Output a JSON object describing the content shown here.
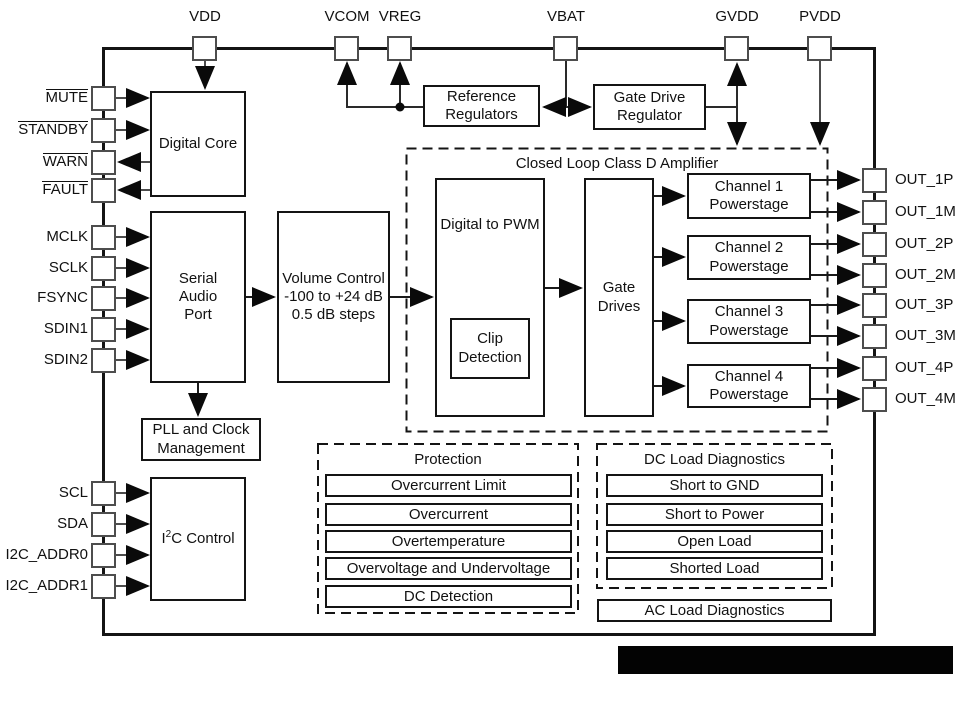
{
  "pins": {
    "top": [
      "VDD",
      "VCOM",
      "VREG",
      "VBAT",
      "GVDD",
      "PVDD"
    ],
    "left": [
      "MUTE",
      "STANDBY",
      "WARN",
      "FAULT",
      "MCLK",
      "SCLK",
      "FSYNC",
      "SDIN1",
      "SDIN2",
      "SCL",
      "SDA",
      "I2C_ADDR0",
      "I2C_ADDR1"
    ],
    "right": [
      "OUT_1P",
      "OUT_1M",
      "OUT_2P",
      "OUT_2M",
      "OUT_3P",
      "OUT_3M",
      "OUT_4P",
      "OUT_4M"
    ]
  },
  "blocks": {
    "digital_core": "Digital Core",
    "serial_audio_port": "Serial\nAudio\nPort",
    "volume_control": "Volume Control\n-100 to +24 dB\n0.5 dB steps",
    "pll": "PLL and Clock\nManagement",
    "i2c_control": {
      "pre": "I",
      "sup": "2",
      "post": "C Control"
    },
    "reference_regulators": "Reference\nRegulators",
    "gate_drive_regulator": "Gate Drive\nRegulator",
    "amp_title": "Closed Loop Class D Amplifier",
    "digital_to_pwm": "Digital to PWM",
    "clip_detection": "Clip\nDetection",
    "gate_drives": "Gate\nDrives",
    "channel1": "Channel 1\nPowerstage",
    "channel2": "Channel 2\nPowerstage",
    "channel3": "Channel 3\nPowerstage",
    "channel4": "Channel 4\nPowerstage"
  },
  "protection": {
    "title": "Protection",
    "rows": [
      "Overcurrent Limit",
      "Overcurrent",
      "Overtemperature",
      "Overvoltage and Undervoltage",
      "DC Detection"
    ]
  },
  "dc_load": {
    "title": "DC Load Diagnostics",
    "rows": [
      "Short to GND",
      "Short to Power",
      "Open Load",
      "Shorted Load"
    ]
  },
  "ac_load": "AC Load Diagnostics",
  "colors": {
    "wire": "#1a1a1a",
    "stub": "#4c4c4c",
    "arrow": "#0a0a0a"
  }
}
